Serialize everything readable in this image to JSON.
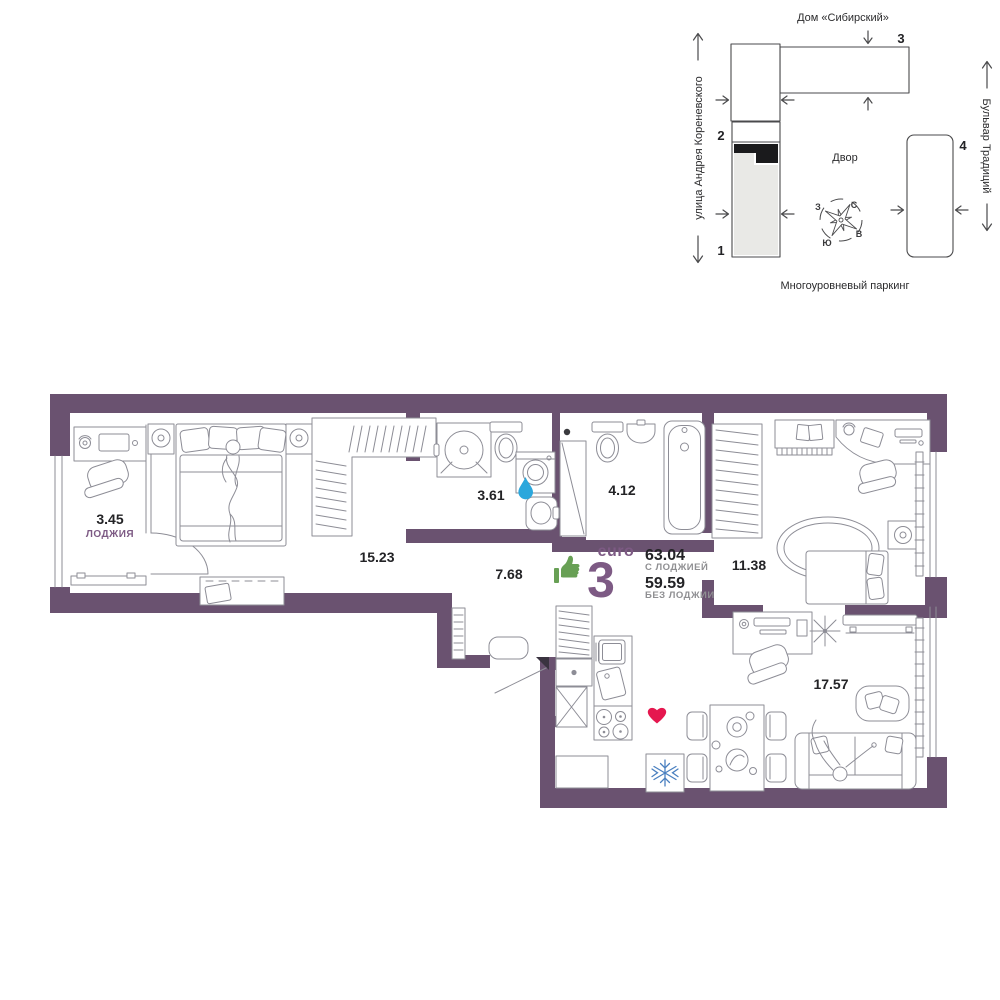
{
  "site_plan": {
    "title": "Дом «Сибирский»",
    "street_left": "улица Андрея Кореневского",
    "street_right": "Бульвар Традиций",
    "parking_label": "Многоуровневый паркинг",
    "courtyard_label": "Двор",
    "building_1": "1",
    "building_2": "2",
    "building_3": "3",
    "building_4": "4",
    "compass": {
      "north": "С",
      "south": "Ю",
      "west": "З",
      "east": "В"
    }
  },
  "apartment": {
    "type_label": "euro",
    "rooms_count": "3",
    "area_with_loggia": "63.04",
    "area_with_loggia_caption": "С ЛОДЖИЕЙ",
    "area_without_loggia": "59.59",
    "area_without_loggia_caption": "БЕЗ ЛОДЖИИ",
    "rooms": {
      "loggia": {
        "area": "3.45",
        "label": "ЛОДЖИЯ"
      },
      "bedroom": {
        "area": "15.23"
      },
      "shower_room": {
        "area": "3.61"
      },
      "bathroom": {
        "area": "4.12"
      },
      "hallway": {
        "area": "7.68"
      },
      "bedroom_2": {
        "area": "11.38"
      },
      "kitchen_living": {
        "area": "17.57"
      }
    }
  },
  "icons": {
    "thumbs_up": "thumbs-up",
    "water_drop": "water-drop",
    "heart": "heart",
    "snowflake": "snowflake"
  },
  "colors": {
    "wall": "#6A5270",
    "accent": "#7D5A84",
    "green": "#68A055",
    "blue": "#2BA7DC",
    "red": "#E5174F",
    "steel_blue": "#4A80C0"
  }
}
